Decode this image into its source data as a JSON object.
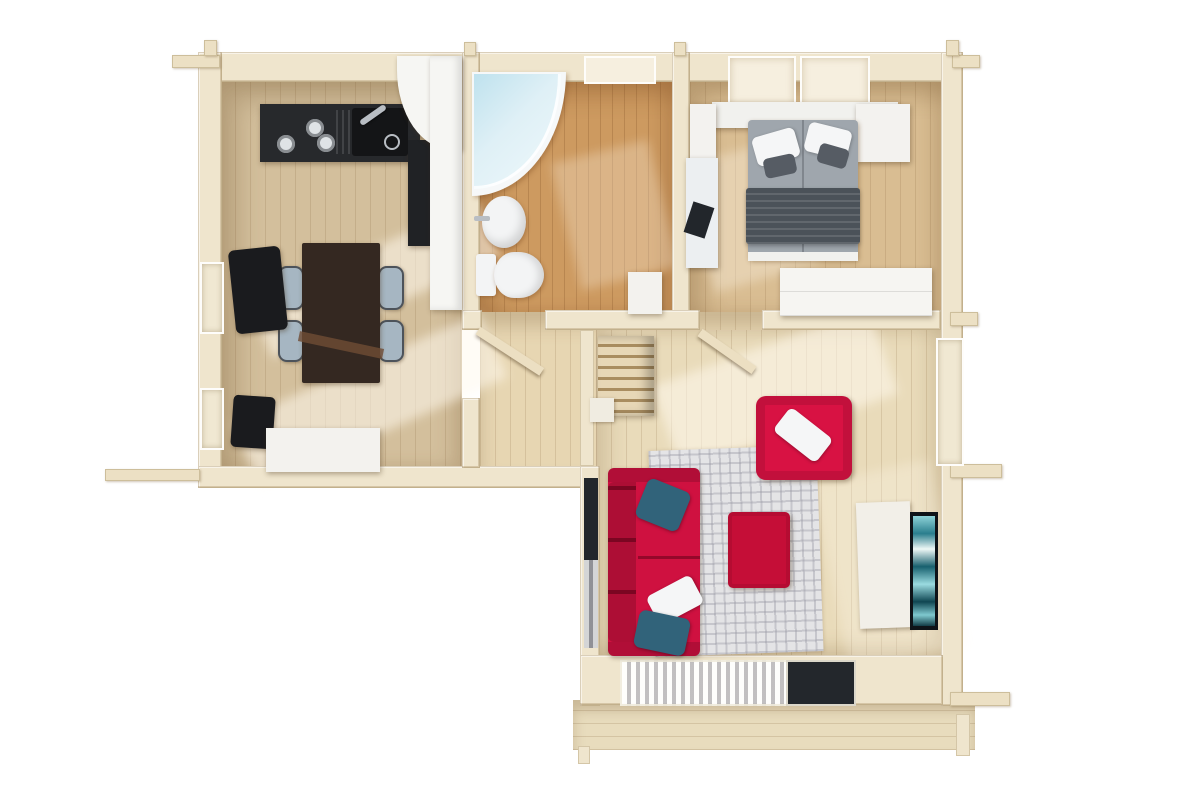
{
  "scene": {
    "description": "3D top-down render of a log cabin floor plan with kitchen-dining room, bathroom, bedroom, hallway with staircase, living room and terrace",
    "view": "top-down-3d-render",
    "background": "#ffffff"
  },
  "palette": {
    "wall": "#efe5cd",
    "beam": "#ece0c4",
    "door": "#ecdfc2",
    "floor_kitchen": "#d3bf9c",
    "floor_bath": "#cd9a60",
    "floor_bedroom": "#d9bd92",
    "floor_hall": "#e7d6b2",
    "floor_living": "#e9dbba",
    "deck": "#e8dcbd",
    "counter": "#27292c",
    "counter_sink": "#141517",
    "appliance_dark": "#202225",
    "fridge": "#f6f6f3",
    "burner": "#dfe3e6",
    "chrome": "#b9bec4",
    "table": "#342821",
    "table_runner": "#6f4c34",
    "chair_seat": "#a6b6c2",
    "black_chair": "#1a1b1e",
    "white_box": "#f3f2ee",
    "shower_tray": "#f6f8f9",
    "porcelain": "#f3f4f5",
    "bed_headboard": "#f1f1ee",
    "mattress": "#9fa6ad",
    "blanket": "#4b5259",
    "pillow_white": "#f5f6f7",
    "pillow_dark": "#565c64",
    "wardrobe": "#f3f2ef",
    "desk": "#eceff1",
    "laptop": "#22262b",
    "dresser": "#f6f5f2",
    "sofa": "#cf1140",
    "armchair": "#d81243",
    "ottoman": "#c50e37",
    "pillow_blue": "#31637a",
    "rug": "#e4e4e6",
    "sideboard": "#f2efe8",
    "tv_frame": "#0e1318",
    "glass_dark": "#23272c",
    "window_glass": "#f0e8d2",
    "skylight": "#f6efdf",
    "stair_landing": "#f0ece1"
  },
  "rooms": [
    {
      "id": "kitchen-dining",
      "label": "kitchen / dining room"
    },
    {
      "id": "bathroom",
      "label": "bathroom"
    },
    {
      "id": "bedroom",
      "label": "bedroom"
    },
    {
      "id": "hallway",
      "label": "hallway with staircase"
    },
    {
      "id": "living-room",
      "label": "living room"
    },
    {
      "id": "terrace",
      "label": "terrace deck"
    }
  ],
  "inventory": {
    "kitchen_dining": [
      "kitchen counter with hob and sink",
      "oven tower",
      "fridge cabinet",
      "dining table",
      "four chairs",
      "two black window chairs",
      "storage chest"
    ],
    "bathroom": [
      "corner shower",
      "washbasin",
      "toilet",
      "small cabinet"
    ],
    "bedroom": [
      "double bed",
      "white pillows",
      "dark pillows",
      "blanket",
      "nightstand",
      "wardrobe",
      "desk with laptop",
      "dresser"
    ],
    "hallway": [
      "staircase",
      "two open doors"
    ],
    "living_room": [
      "three-seat sofa",
      "armchair",
      "ottoman",
      "maze rug",
      "tv sideboard",
      "wall tv",
      "blue pillows",
      "white pillows",
      "glazed wall with curtains"
    ],
    "terrace": [
      "deck boards",
      "support posts"
    ]
  }
}
